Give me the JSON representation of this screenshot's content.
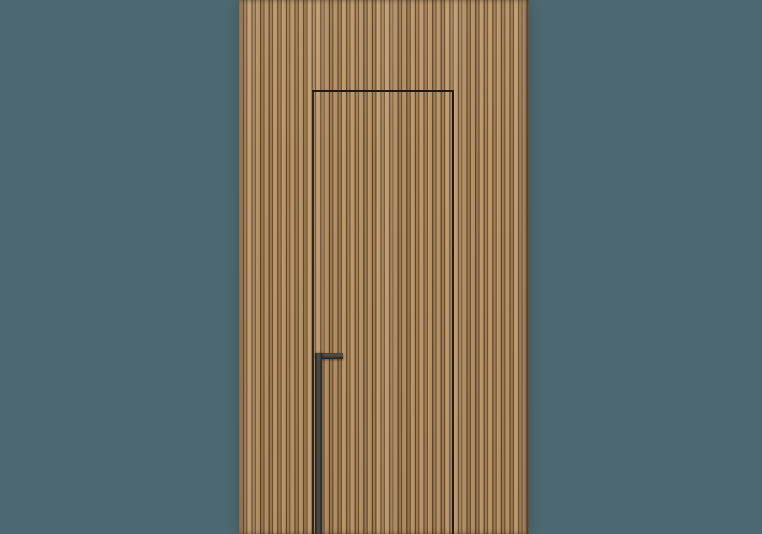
{
  "scene": {
    "description": "Product render of a concealed flush door integrated into a vertically slatted oak wood wall panel, with a slim dark recessed pull handle, on a plain slate teal background",
    "elements": {
      "backdrop": "plain slate-teal studio background",
      "wood_panel": "full-height vertical slatted wood panel, ribbed fluted texture",
      "door_gap": "thin dark reveal line outlining the hidden door: horizontal top edge and two vertical edges running to the floor",
      "handle": "matte black L-shaped recessed pull handle on the left door edge"
    }
  },
  "theme": {
    "backdrop": "#4c6871",
    "wood-light": "#c39c6c",
    "wood-light2": "#b99367",
    "wood-medium": "#a57f54",
    "groove-dark": "#6d5336",
    "groove-deep": "#5d4730",
    "gap-line": "#221a10",
    "handle-dark": "#23211d",
    "handle-mid": "#45423c",
    "handle-light": "#514e47"
  }
}
